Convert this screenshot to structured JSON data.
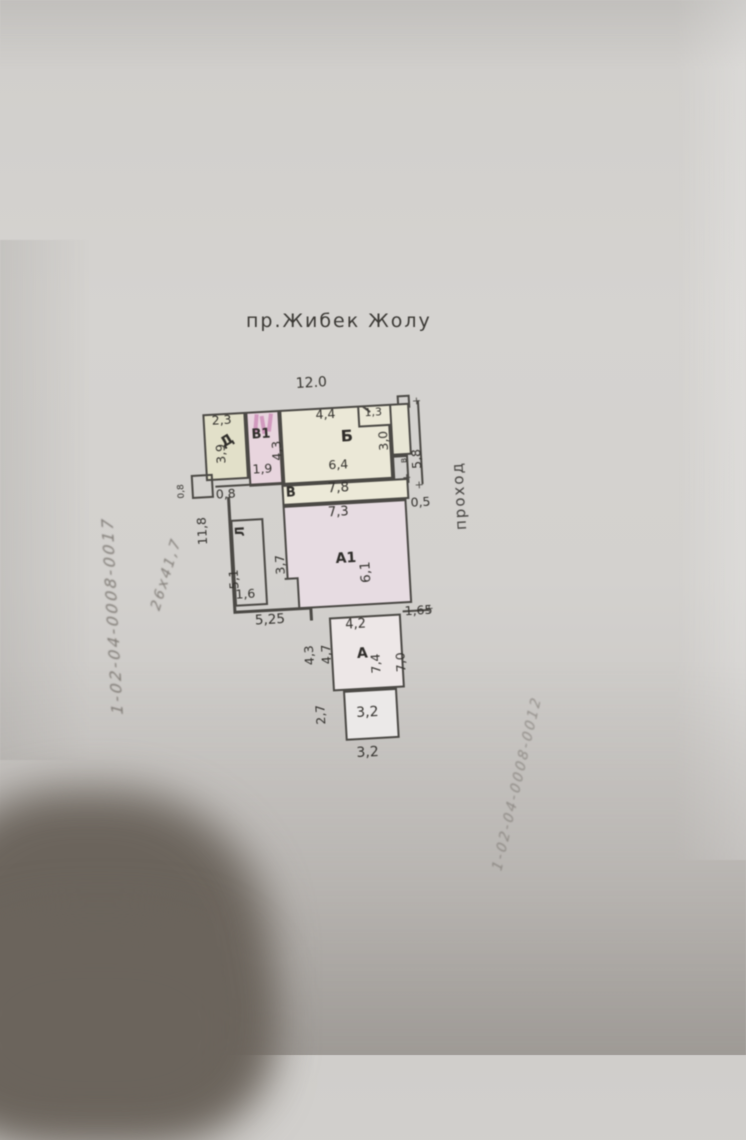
{
  "photo": {
    "street_label": "пр.Жибек  Жолу",
    "passage_label": "проход"
  },
  "plan": {
    "rooms": {
      "d": "Д",
      "b1": "В1",
      "b": "Б",
      "corridor": "В",
      "l": "Л",
      "a1": "А1",
      "a": "А",
      "wing": "в"
    },
    "dims": {
      "top_width": "12.0",
      "d_width": "2,3",
      "d_depth": "3,9",
      "b1_bottom": "1,9",
      "b_top": "4,4",
      "b_left": "4,3",
      "b_bottom": "6,4",
      "closet": "1,3",
      "wing_depth": "3,0",
      "right_height": "5,8",
      "corridor_length": "7,8",
      "left_offset": "0,8",
      "left_offset_small": "0,8",
      "left_height": "11,8",
      "l_depth": "5,1",
      "l_width": "1,6",
      "bottom_left_width": "5,25",
      "a1_top": "7,3",
      "a1_left": "3,7",
      "a1_right": "6,1",
      "passage_width": "0,5",
      "a_top": "4,2",
      "a_top_right": "1,65",
      "a_left_outer": "4,3",
      "a_left_inner": "4,7",
      "a_right_inner": "7,4",
      "a_right_outer": "7,0",
      "a_bottom_left": "2,7",
      "box_width_inner": "3,2",
      "box_width_outer": "3,2"
    }
  },
  "handwriting": {
    "left_note": "1-02-04-0008-0017",
    "size_note": "26х41,7",
    "right_note": "1-02-04-0008-0012"
  },
  "colors": {
    "paper": "#d2d0cd",
    "room_yellow": "#ebe8d7",
    "room_khaki": "#e2e0c9",
    "room_pink": "#e8d5de",
    "room_lavender": "#e7dce2",
    "wall": "#4b4945",
    "shadow_blob": "#6b645c"
  }
}
